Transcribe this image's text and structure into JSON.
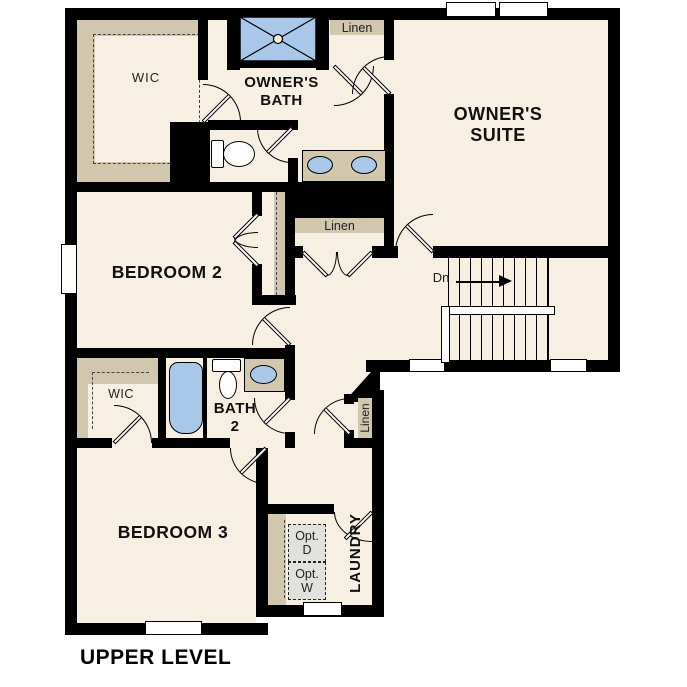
{
  "title": "UPPER LEVEL",
  "colors": {
    "background": "#ffffff",
    "floor": "#f6efe2",
    "wall": "#000000",
    "shelf_counter": "#d2c6ac",
    "fixture_blue": "#a9c8e9",
    "appliance_gray": "#e1e1de"
  },
  "rooms": {
    "owners_suite": {
      "label": "OWNER'S\nSUITE"
    },
    "owners_bath": {
      "label": "OWNER'S\nBATH"
    },
    "bedroom2": {
      "label": "BEDROOM 2"
    },
    "bedroom3": {
      "label": "BEDROOM 3"
    },
    "bath2": {
      "label": "BATH\n2"
    },
    "laundry": {
      "label": "LAUNDRY"
    },
    "wic_owners": {
      "label": "WIC"
    },
    "wic_bath2": {
      "label": "WIC"
    }
  },
  "closets": {
    "linen_top": {
      "label": "Linen"
    },
    "linen_hall": {
      "label": "Linen"
    },
    "linen_lower": {
      "label": "Linen"
    }
  },
  "stairs": {
    "down_label": "Dn"
  },
  "appliances": {
    "optional_dryer": {
      "label": "Opt.\nD"
    },
    "optional_washer": {
      "label": "Opt.\nW"
    }
  }
}
